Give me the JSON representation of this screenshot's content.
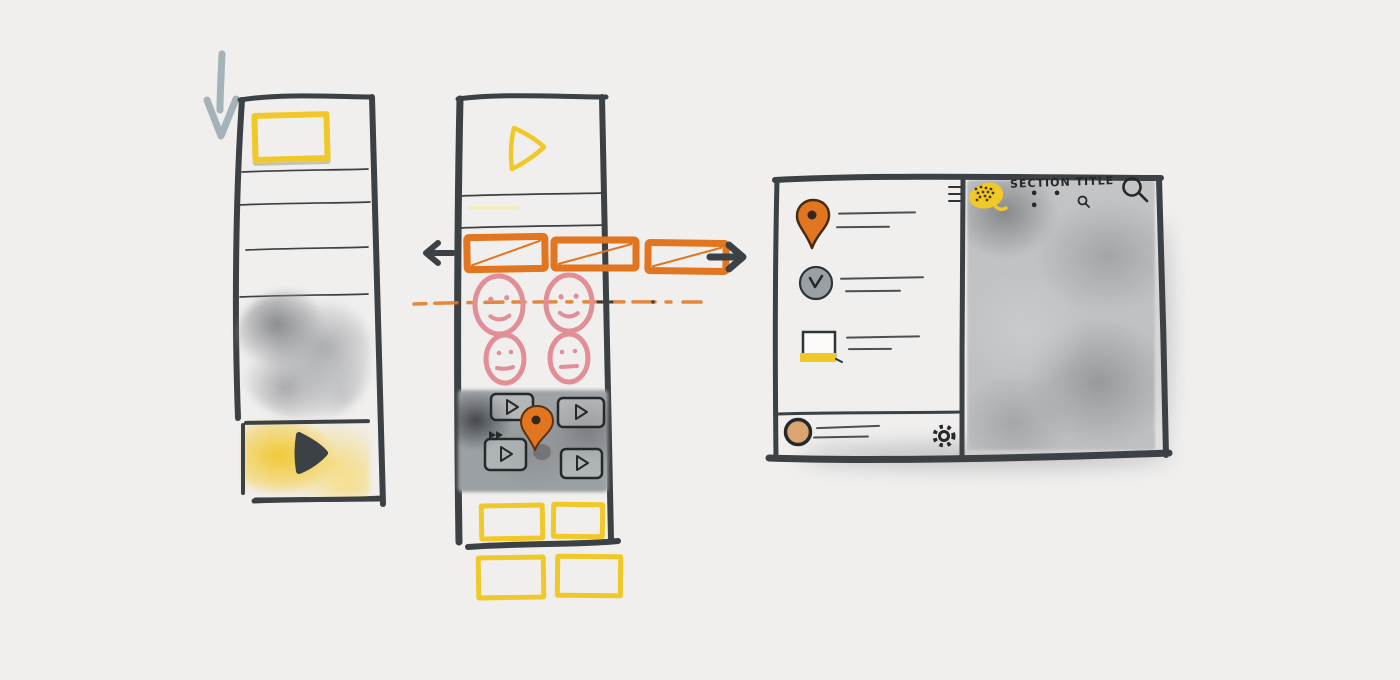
{
  "colors": {
    "background": "#f0efee",
    "ink": "#3b4144",
    "yellow": "#f0c929",
    "orange": "#e2751f",
    "pink": "#e18e97",
    "blue_gray": "#a4b3b7",
    "tan": "#dba572",
    "gray_icon": "#9aa0a4",
    "gray_wash": "#bcbdbf"
  },
  "flow": {
    "down_arrow_icon": "scroll-down-arrow-icon",
    "prev_arrow_icon": "swipe-left-arrow-icon",
    "next_arrow_icon": "swipe-right-arrow-icon",
    "connector": "horizontal-swipe-dashed-line"
  },
  "left_phone": {
    "header_placeholder": {
      "icon": "image-placeholder",
      "color": "yellow"
    },
    "text_line_count": 4,
    "photo_placeholder": {
      "type": "watercolor-block",
      "color": "gray"
    },
    "video_block": {
      "icon": "play-icon",
      "color": "yellow"
    }
  },
  "center_phone": {
    "hero": {
      "icon": "play-outline-icon",
      "color": "yellow"
    },
    "carousel": {
      "card_count": 3,
      "card_style": "crossed-rectangle",
      "color": "orange"
    },
    "avatars": {
      "count": 4,
      "style": "smiley-face",
      "color": "pink"
    },
    "video_grid": {
      "tile_count": 4,
      "tile_icon": "play-icon",
      "overlay_icon": "map-pin-icon",
      "corner_icon": "fast-forward-icon",
      "color": "gray"
    },
    "thumbnails": {
      "count": 4,
      "color": "yellow"
    }
  },
  "desktop_panel": {
    "header": {
      "menu_icon": "hamburger-icon",
      "logo_icon": "cookie-logo-icon",
      "title": "SECTION TITLE",
      "subtitle_dots": "• • •",
      "subtitle_search_icon": "magnifier-icon",
      "search_icon": "magnifier-icon"
    },
    "sidebar": {
      "items": [
        {
          "icon": "map-pin-icon",
          "line_count": 2
        },
        {
          "icon": "clock-icon",
          "line_count": 2
        },
        {
          "icon": "folder-icon",
          "line_count": 2
        }
      ],
      "footer": {
        "left_icon": "avatar",
        "line_count": 2,
        "right_icon": "gear-icon"
      }
    },
    "content": {
      "type": "map-placeholder",
      "color": "gray"
    }
  }
}
